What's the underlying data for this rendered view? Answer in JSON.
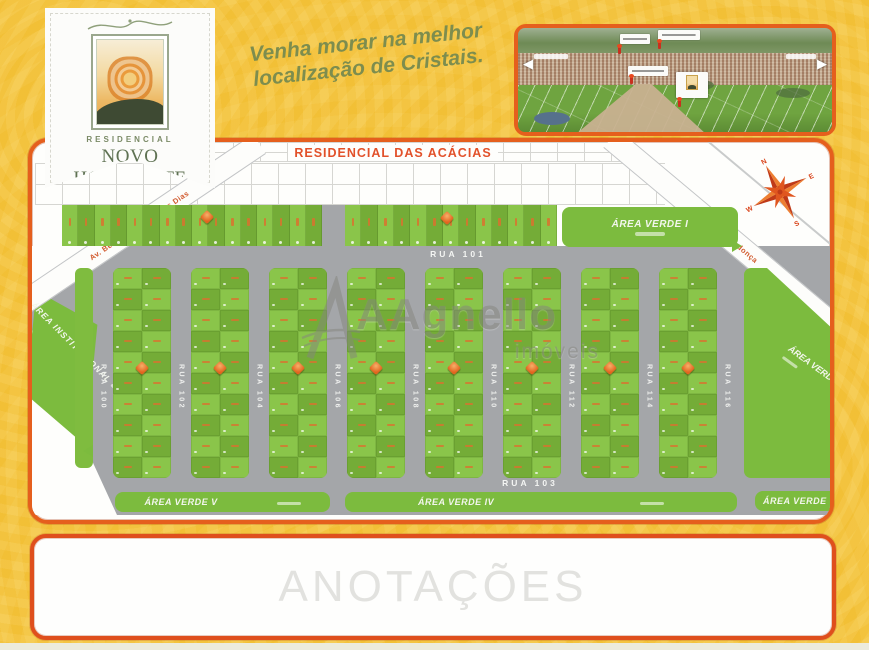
{
  "page": {
    "slogan": "Venha morar na melhor\nlocalização de Cristais.",
    "annotations_label": "ANOTAÇÕES"
  },
  "logo": {
    "tagline": "RESIDENCIAL",
    "name": "NOVO HORIZONTE"
  },
  "watermark": {
    "name": "AAgnello",
    "suffix": "imóveis"
  },
  "map": {
    "district_label": "RESIDENCIAL DAS ACÁCIAS",
    "horizontal_streets": [
      {
        "label": "RUA 101"
      },
      {
        "label": "RUA 103"
      }
    ],
    "vertical_streets": [
      {
        "label": "RUA 100"
      },
      {
        "label": "RUA 102"
      },
      {
        "label": "RUA 104"
      },
      {
        "label": "RUA 106"
      },
      {
        "label": "RUA 108"
      },
      {
        "label": "RUA 110"
      },
      {
        "label": "RUA 112"
      },
      {
        "label": "RUA 114"
      },
      {
        "label": "RUA 116"
      }
    ],
    "diagonal_streets": [
      {
        "label": "Av. Benjamin Gonçalves Dias"
      },
      {
        "label": "Rua Vitor Mendonça"
      }
    ],
    "areas": {
      "verde1": "ÁREA VERDE I",
      "verde2": "ÁREA VERDE",
      "verde3": "ÁREA VERDE",
      "verde4": "ÁREA VERDE IV",
      "verde5": "ÁREA VERDE V",
      "institucional": "ÁREA INSTITUCIONAL"
    },
    "compass_points": [
      "N",
      "S",
      "E",
      "W"
    ],
    "layout": {
      "blocks": 8,
      "rows": 10,
      "cols": 2,
      "top_row_a": 16,
      "top_row_b": 13
    }
  },
  "colors": {
    "background": "#F6C53B",
    "frame_orange": "#E55F1D",
    "lot_green_light": "#8AC54A",
    "lot_green_dark": "#74AC37",
    "area_green": "#7CBB3E",
    "street_gray": "#A4A6A9",
    "red_label": "#E2512A",
    "logo_green": "#5F7253",
    "slogan_green": "#7D8D4E",
    "marker_orange": "#E2651F"
  }
}
